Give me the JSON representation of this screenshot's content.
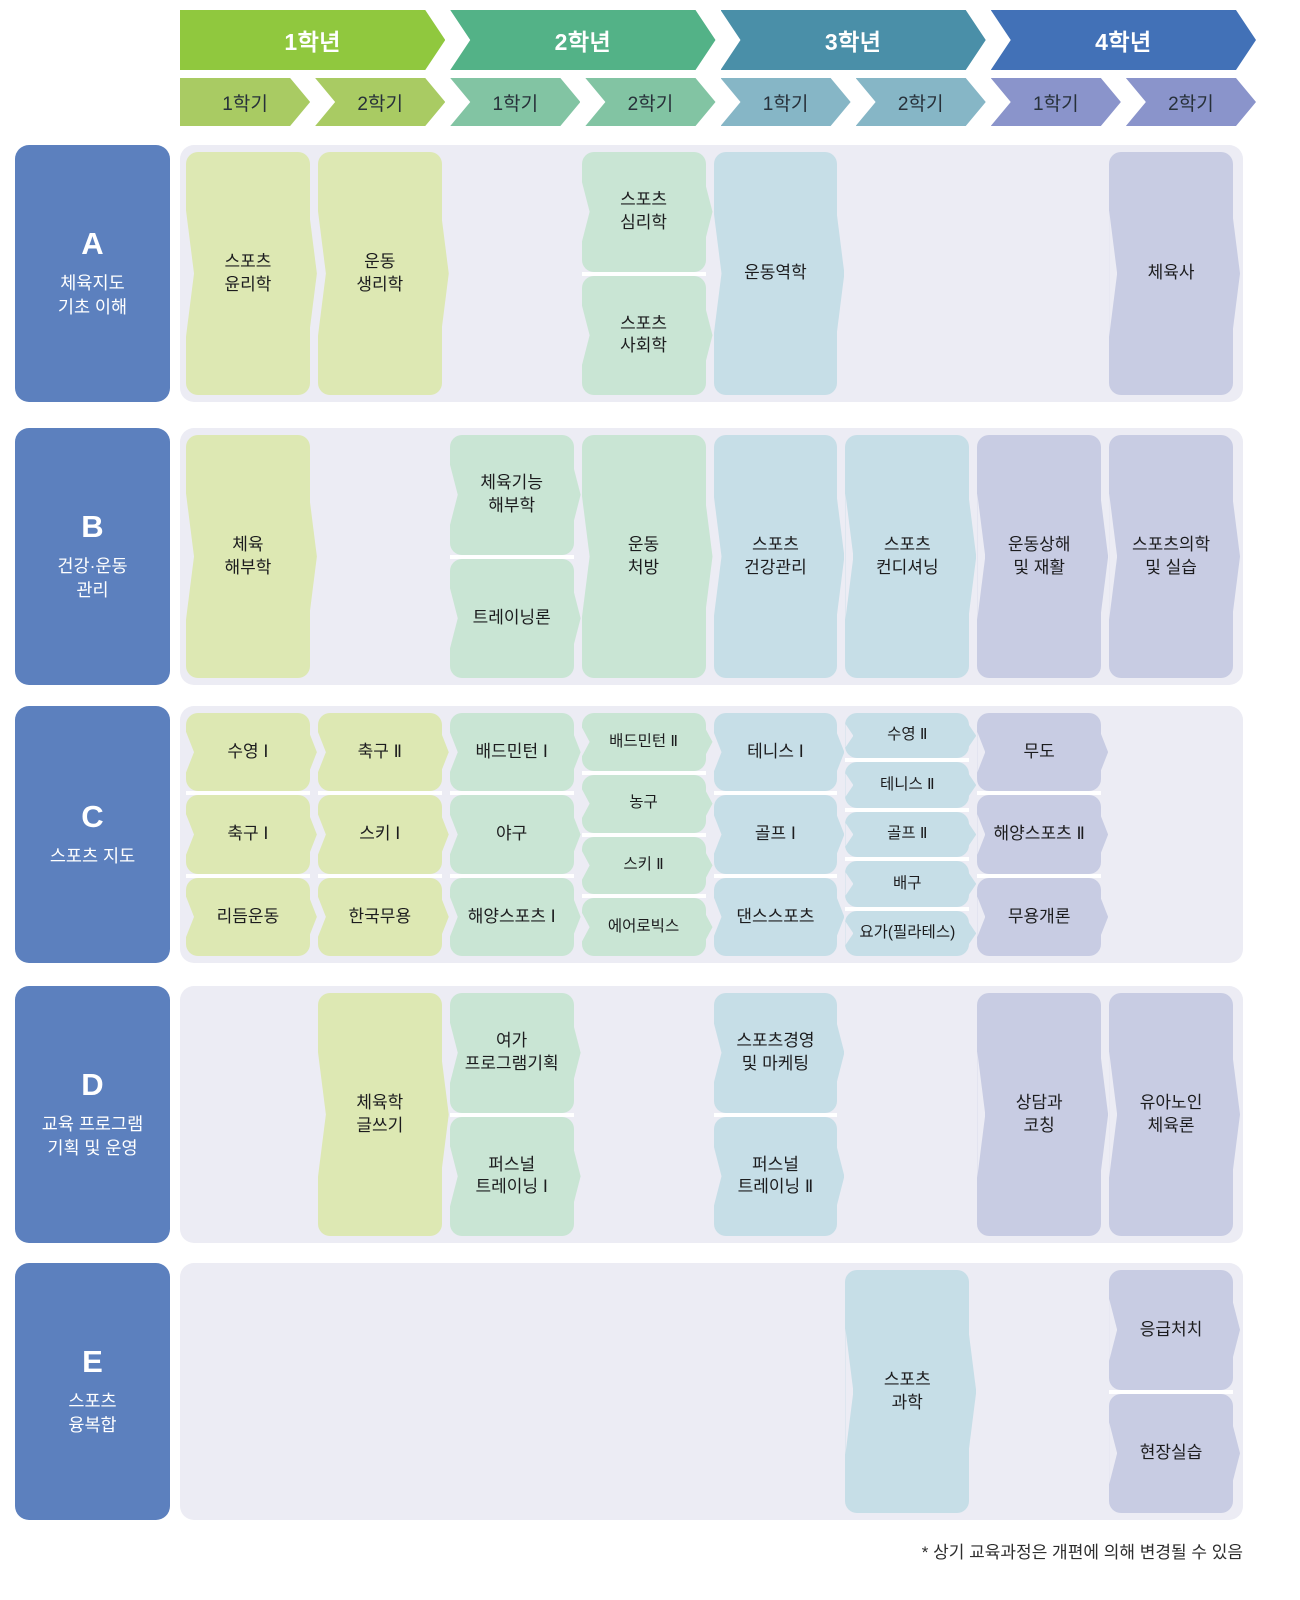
{
  "colors": {
    "panel_bg": "#ECECF4",
    "row_label_bg": "#5C80BE",
    "card_text": "#1C1C1E",
    "stack_divider": "#FFFFFF"
  },
  "years": [
    {
      "name": "1학년",
      "banner_color": "#90C83E",
      "semester_color": "#A9CB63",
      "card_color": "#DDE8B3",
      "semesters": [
        "1학기",
        "2학기"
      ]
    },
    {
      "name": "2학년",
      "banner_color": "#53B287",
      "semester_color": "#82C4A3",
      "card_color": "#C9E5D4",
      "semesters": [
        "1학기",
        "2학기"
      ]
    },
    {
      "name": "3학년",
      "banner_color": "#4A8FA8",
      "semester_color": "#86B6C6",
      "card_color": "#C6DEE7",
      "semesters": [
        "1학기",
        "2학기"
      ]
    },
    {
      "name": "4학년",
      "banner_color": "#4271B7",
      "semester_color": "#8A94CB",
      "card_color": "#C8CCE3",
      "semesters": [
        "1학기",
        "2학기"
      ]
    }
  ],
  "rows": [
    {
      "letter": "A",
      "title": "체육지도\n기초 이해",
      "cells": [
        {
          "col": 0,
          "year": 0,
          "courses": [
            "스포츠\n윤리학"
          ]
        },
        {
          "col": 1,
          "year": 0,
          "courses": [
            "운동\n생리학"
          ]
        },
        {
          "col": 3,
          "year": 1,
          "courses": [
            "스포츠\n심리학",
            "스포츠\n사회학"
          ]
        },
        {
          "col": 4,
          "year": 2,
          "courses": [
            "운동역학"
          ]
        },
        {
          "col": 7,
          "year": 3,
          "courses": [
            "체육사"
          ]
        }
      ]
    },
    {
      "letter": "B",
      "title": "건강·운동\n관리",
      "cells": [
        {
          "col": 0,
          "year": 0,
          "courses": [
            "체육\n해부학"
          ]
        },
        {
          "col": 2,
          "year": 1,
          "courses": [
            "체육기능\n해부학",
            "트레이닝론"
          ]
        },
        {
          "col": 3,
          "year": 1,
          "courses": [
            "운동\n처방"
          ]
        },
        {
          "col": 4,
          "year": 2,
          "courses": [
            "스포츠\n건강관리"
          ]
        },
        {
          "col": 5,
          "year": 2,
          "courses": [
            "스포츠\n컨디셔닝"
          ]
        },
        {
          "col": 6,
          "year": 3,
          "courses": [
            "운동상해\n및 재활"
          ]
        },
        {
          "col": 7,
          "year": 3,
          "courses": [
            "스포츠의학\n및 실습"
          ]
        }
      ]
    },
    {
      "letter": "C",
      "title": "스포츠 지도",
      "cells": [
        {
          "col": 0,
          "year": 0,
          "courses": [
            "수영 Ⅰ",
            "축구 Ⅰ",
            "리듬운동"
          ]
        },
        {
          "col": 1,
          "year": 0,
          "courses": [
            "축구 Ⅱ",
            "스키 Ⅰ",
            "한국무용"
          ]
        },
        {
          "col": 2,
          "year": 1,
          "courses": [
            "배드민턴 Ⅰ",
            "야구",
            "해양스포츠 Ⅰ"
          ]
        },
        {
          "col": 3,
          "year": 1,
          "courses": [
            "배드민턴 Ⅱ",
            "농구",
            "스키 Ⅱ",
            "에어로빅스"
          ]
        },
        {
          "col": 4,
          "year": 2,
          "courses": [
            "테니스 Ⅰ",
            "골프 Ⅰ",
            "댄스스포츠"
          ]
        },
        {
          "col": 5,
          "year": 2,
          "courses": [
            "수영 Ⅱ",
            "테니스 Ⅱ",
            "골프 Ⅱ",
            "배구",
            "요가(필라테스)"
          ]
        },
        {
          "col": 6,
          "year": 3,
          "courses": [
            "무도",
            "해양스포츠 Ⅱ",
            "무용개론"
          ]
        }
      ]
    },
    {
      "letter": "D",
      "title": "교육 프로그램\n기획 및 운영",
      "cells": [
        {
          "col": 1,
          "year": 0,
          "courses": [
            "체육학\n글쓰기"
          ]
        },
        {
          "col": 2,
          "year": 1,
          "courses": [
            "여가\n프로그램기획",
            "퍼스널\n트레이닝 Ⅰ"
          ]
        },
        {
          "col": 4,
          "year": 2,
          "courses": [
            "스포츠경영\n및 마케팅",
            "퍼스널\n트레이닝 Ⅱ"
          ]
        },
        {
          "col": 6,
          "year": 3,
          "courses": [
            "상담과\n코칭"
          ]
        },
        {
          "col": 7,
          "year": 3,
          "courses": [
            "유아노인\n체육론"
          ]
        }
      ]
    },
    {
      "letter": "E",
      "title": "스포츠\n융복합",
      "cells": [
        {
          "col": 5,
          "year": 2,
          "courses": [
            "스포츠\n과학"
          ]
        },
        {
          "col": 7,
          "year": 3,
          "courses": [
            "응급처치",
            "현장실습"
          ]
        }
      ]
    }
  ],
  "footnote": "* 상기 교육과정은 개편에 의해 변경될 수 있음"
}
